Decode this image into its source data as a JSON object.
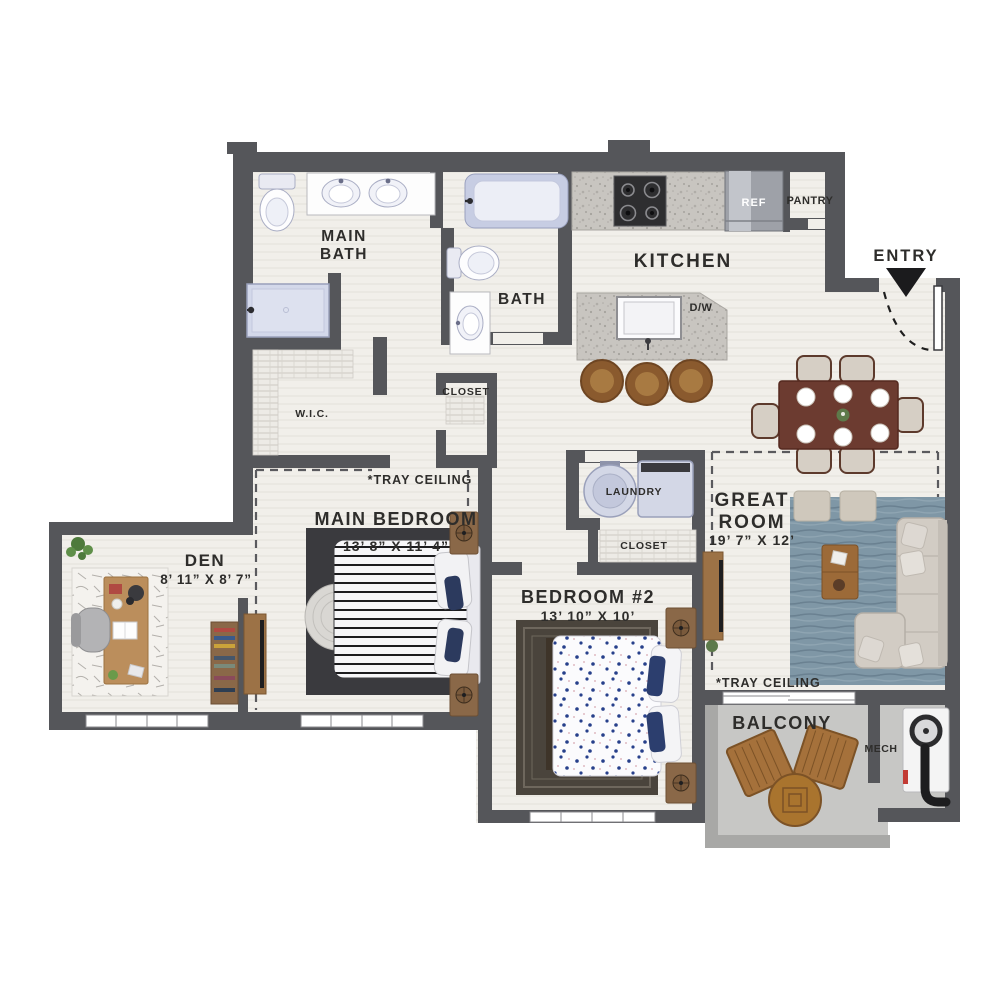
{
  "rooms": {
    "main_bath": {
      "line1": "MAIN",
      "line2": "BATH"
    },
    "bath": {
      "label": "BATH"
    },
    "kitchen": {
      "label": "KITCHEN"
    },
    "pantry": {
      "label": "PANTRY"
    },
    "wic": {
      "label": "W.I.C."
    },
    "hall_closet": {
      "label": "CLOSET"
    },
    "laundry": {
      "label": "LAUNDRY"
    },
    "bedroom2_closet": {
      "label": "CLOSET"
    },
    "main_bedroom": {
      "label": "MAIN BEDROOM",
      "dims": "13’ 8” X 11’ 4”"
    },
    "den": {
      "label": "DEN",
      "dims": "8’ 11” X 8’ 7”"
    },
    "bedroom_2": {
      "label": "BEDROOM #2",
      "dims": "13’ 10” X 10’"
    },
    "great_room": {
      "line1": "GREAT",
      "line2": "ROOM",
      "dims": "19’ 7” X 12’"
    },
    "balcony": {
      "label": "BALCONY"
    },
    "mech": {
      "label": "MECH"
    }
  },
  "labels": {
    "entry": "ENTRY",
    "tray_ceiling_main_bedroom": "*TRAY CEILING",
    "tray_ceiling_great_room": "*TRAY CEILING",
    "ref": "REF",
    "dishwasher": "D/W"
  },
  "colors": {
    "wall": "#55565a",
    "balcony_wall": "#a8a8a6",
    "floor": "#f1efea",
    "balcony_floor": "#c7c7c5",
    "text": "#2e2d2b",
    "granite": "#c8c5c0",
    "fixture_blue": "#ccd2e6",
    "great_room_rug": "#7f97a6",
    "wood": "#a4713d",
    "dining_table": "#6c3b30",
    "sofa": "#d2ccc4"
  }
}
